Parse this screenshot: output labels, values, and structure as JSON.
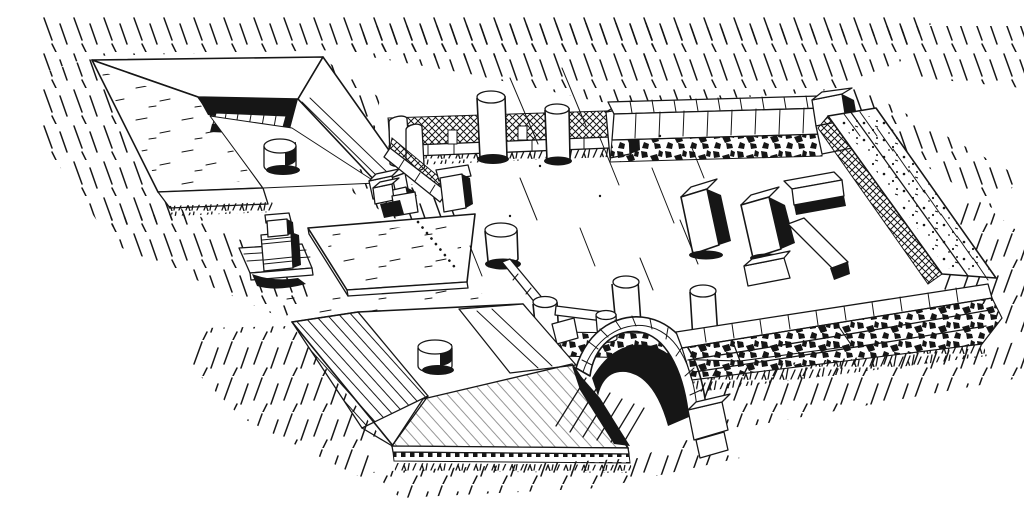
{
  "page": {
    "background_color": "#ffffff",
    "ink_color": "#161616"
  },
  "figure": {
    "title": "Pen-and-ink perspective drawing of excavated Roman funerary enclosure",
    "description": "Hand-drawn black ink perspective view of ruins: a U-shaped masonry triclinium with a round monopodium table, a small altar on a stepped base, a fallen flat slab, a low fence with broken column stumps, a rubble wall carrying more column stumps and a voussoir arch, a second large triclinium platform with round table and dentil base moulding, all enclosed on the right by walls of rough stone blocks, with grass rendered as short hatched strokes",
    "elements": [
      "ground-hatching",
      "u-triclinium",
      "round-table-1",
      "altar",
      "fallen-slab",
      "dotted-wall-trace",
      "fence-colonnade",
      "column-stumps",
      "rubble-wall-with-stumps",
      "arch",
      "triclinium-platform",
      "round-table-2",
      "dentil-frieze",
      "enclosure-back-wall",
      "enclosure-right-wall",
      "enclosure-front-wall",
      "interior-pillars",
      "interior-low-walls"
    ]
  }
}
